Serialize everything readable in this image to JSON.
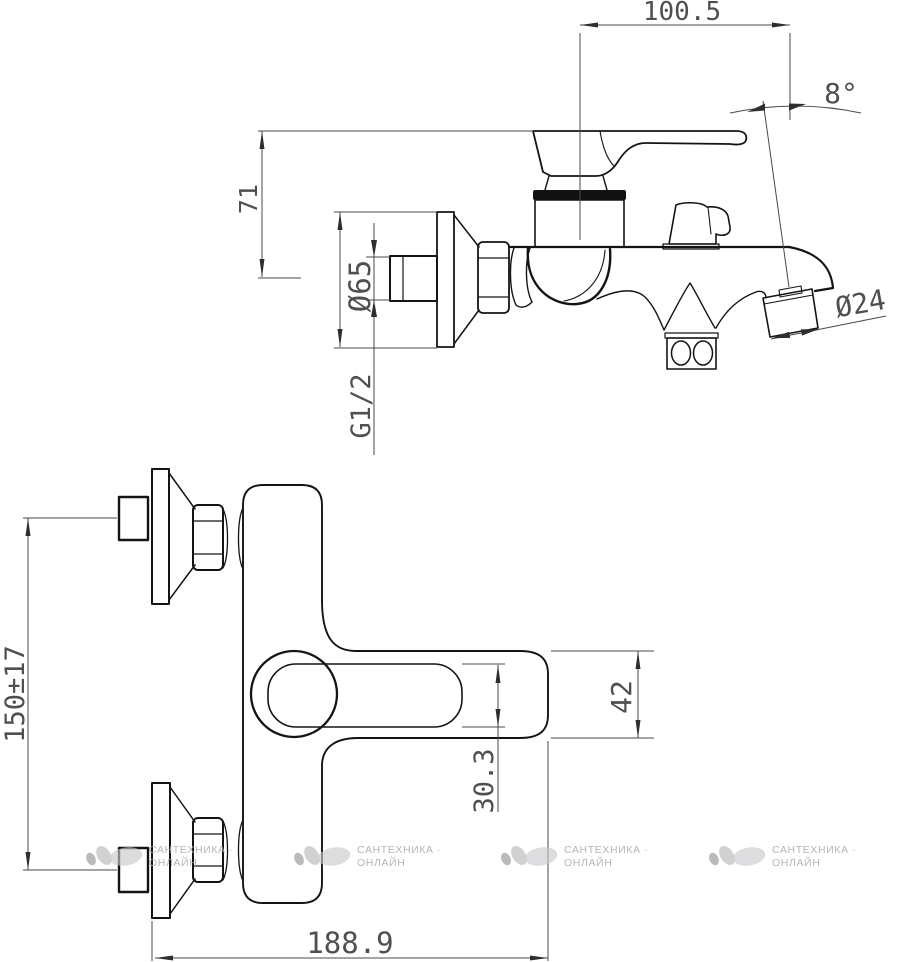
{
  "drawing": {
    "type": "technical-dimension-drawing",
    "subject": "wall-mounted bath mixer faucet, side view (top) and front view (bottom)",
    "dimensions": {
      "top_width": "100.5",
      "spout_angle": "8°",
      "wall_to_top": "71",
      "escutcheon_diameter": "Ø65",
      "thread_size": "G1/2",
      "spout_outlet_diameter": "Ø24",
      "inlet_centers_distance": "150±17",
      "handle_height": "42",
      "lever_height": "30.3",
      "overall_length": "188.9"
    }
  },
  "watermark": {
    "line1": "САНТЕХНИКА ·",
    "line2": "ОНЛАЙН",
    "count": 4,
    "color": "#aeaeb2"
  },
  "colors": {
    "background": "#ffffff",
    "line": "#141414",
    "dimension": "#4a4a4a",
    "watermark_logo": "#c3c3c7"
  }
}
